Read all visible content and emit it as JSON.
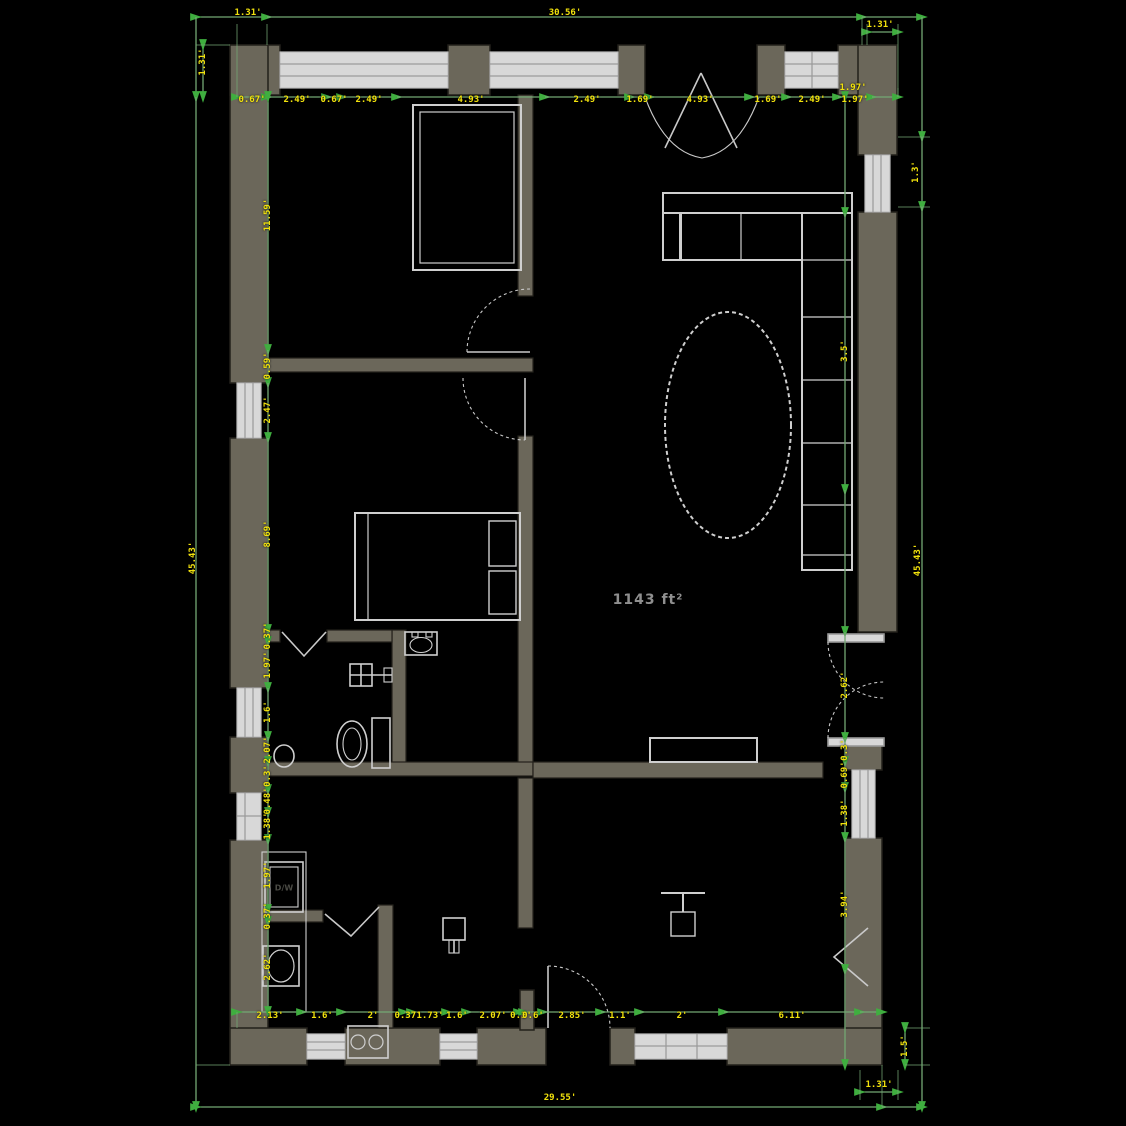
{
  "plan": {
    "area_label": "1143 ft²",
    "appliance_label": "D/W",
    "colors": {
      "background": "#000000",
      "wall_fill": "#6b675a",
      "wall_stroke": "#23211b",
      "fixture_stroke": "#cfcfcf",
      "window_fill": "#d8d8d8",
      "dimension_line": "#74a874",
      "dimension_arrow": "#3fae3f",
      "dimension_text": "#f2e20c",
      "area_text": "#8f8f8f"
    },
    "labels": [
      {
        "x": 248,
        "y": 13,
        "t": "1.31'",
        "r": 0
      },
      {
        "x": 565,
        "y": 13,
        "t": "30.56'",
        "r": 0
      },
      {
        "x": 880,
        "y": 25,
        "t": "1.31'",
        "r": 0
      },
      {
        "x": 252,
        "y": 100,
        "t": "0.67'",
        "r": 0
      },
      {
        "x": 297,
        "y": 100,
        "t": "2.49'",
        "r": 0
      },
      {
        "x": 334,
        "y": 100,
        "t": "0.67'",
        "r": 0
      },
      {
        "x": 369,
        "y": 100,
        "t": "2.49'",
        "r": 0
      },
      {
        "x": 471,
        "y": 100,
        "t": "4.93'",
        "r": 0
      },
      {
        "x": 587,
        "y": 100,
        "t": "2.49'",
        "r": 0
      },
      {
        "x": 640,
        "y": 100,
        "t": "1.69'",
        "r": 0
      },
      {
        "x": 700,
        "y": 100,
        "t": "4.93'",
        "r": 0
      },
      {
        "x": 768,
        "y": 100,
        "t": "1.69'",
        "r": 0
      },
      {
        "x": 812,
        "y": 100,
        "t": "2.49'",
        "r": 0
      },
      {
        "x": 855,
        "y": 100,
        "t": "1.97'",
        "r": 0
      },
      {
        "x": 853,
        "y": 88,
        "t": "1.97'",
        "r": 0
      },
      {
        "x": 203,
        "y": 62,
        "t": "1.31'",
        "r": -90
      },
      {
        "x": 193,
        "y": 558,
        "t": "45.43'",
        "r": -90
      },
      {
        "x": 268,
        "y": 215,
        "t": "11.59'",
        "r": -90
      },
      {
        "x": 268,
        "y": 366,
        "t": "0.59'",
        "r": -90
      },
      {
        "x": 268,
        "y": 410,
        "t": "2.47'",
        "r": -90
      },
      {
        "x": 268,
        "y": 534,
        "t": "8.69'",
        "r": -90
      },
      {
        "x": 268,
        "y": 636,
        "t": "0.37'",
        "r": -90
      },
      {
        "x": 268,
        "y": 665,
        "t": "1.97'",
        "r": -90
      },
      {
        "x": 268,
        "y": 712,
        "t": "1.6'",
        "r": -90
      },
      {
        "x": 268,
        "y": 750,
        "t": "2.07'",
        "r": -90
      },
      {
        "x": 268,
        "y": 776,
        "t": "0.3'",
        "r": -90
      },
      {
        "x": 268,
        "y": 801,
        "t": "0.48'",
        "r": -90
      },
      {
        "x": 268,
        "y": 826,
        "t": "1.38'",
        "r": -90
      },
      {
        "x": 268,
        "y": 875,
        "t": "1.97'",
        "r": -90
      },
      {
        "x": 268,
        "y": 916,
        "t": "0.37'",
        "r": -90
      },
      {
        "x": 268,
        "y": 967,
        "t": "2.62'",
        "r": -90
      },
      {
        "x": 270,
        "y": 1016,
        "t": "2.13'",
        "r": 0
      },
      {
        "x": 322,
        "y": 1016,
        "t": "1.6'",
        "r": 0
      },
      {
        "x": 373,
        "y": 1016,
        "t": "2'",
        "r": 0
      },
      {
        "x": 408,
        "y": 1016,
        "t": "0.37'",
        "r": 0
      },
      {
        "x": 430,
        "y": 1016,
        "t": "1.73'",
        "r": 0
      },
      {
        "x": 457,
        "y": 1016,
        "t": "1.6'",
        "r": 0
      },
      {
        "x": 493,
        "y": 1016,
        "t": "2.07'",
        "r": 0
      },
      {
        "x": 521,
        "y": 1016,
        "t": "0.3'",
        "r": 0
      },
      {
        "x": 533,
        "y": 1016,
        "t": "0.6'",
        "r": 0
      },
      {
        "x": 572,
        "y": 1016,
        "t": "2.85'",
        "r": 0
      },
      {
        "x": 620,
        "y": 1016,
        "t": "1.1'",
        "r": 0
      },
      {
        "x": 682,
        "y": 1016,
        "t": "2'",
        "r": 0
      },
      {
        "x": 792,
        "y": 1016,
        "t": "6.11'",
        "r": 0
      },
      {
        "x": 560,
        "y": 1098,
        "t": "29.55'",
        "r": 0
      },
      {
        "x": 879,
        "y": 1085,
        "t": "1.31'",
        "r": 0
      },
      {
        "x": 905,
        "y": 1046,
        "t": "1.5'",
        "r": -90
      },
      {
        "x": 845,
        "y": 351,
        "t": "3.5'",
        "r": -90
      },
      {
        "x": 845,
        "y": 685,
        "t": "2.62'",
        "r": -90
      },
      {
        "x": 845,
        "y": 750,
        "t": "0.3'",
        "r": -90
      },
      {
        "x": 845,
        "y": 775,
        "t": "0.69'",
        "r": -90
      },
      {
        "x": 845,
        "y": 813,
        "t": "1.38'",
        "r": -90
      },
      {
        "x": 845,
        "y": 904,
        "t": "3.94'",
        "r": -90
      },
      {
        "x": 916,
        "y": 172,
        "t": "1.3'",
        "r": -90
      },
      {
        "x": 918,
        "y": 560,
        "t": "45.43'",
        "r": -90
      }
    ]
  }
}
